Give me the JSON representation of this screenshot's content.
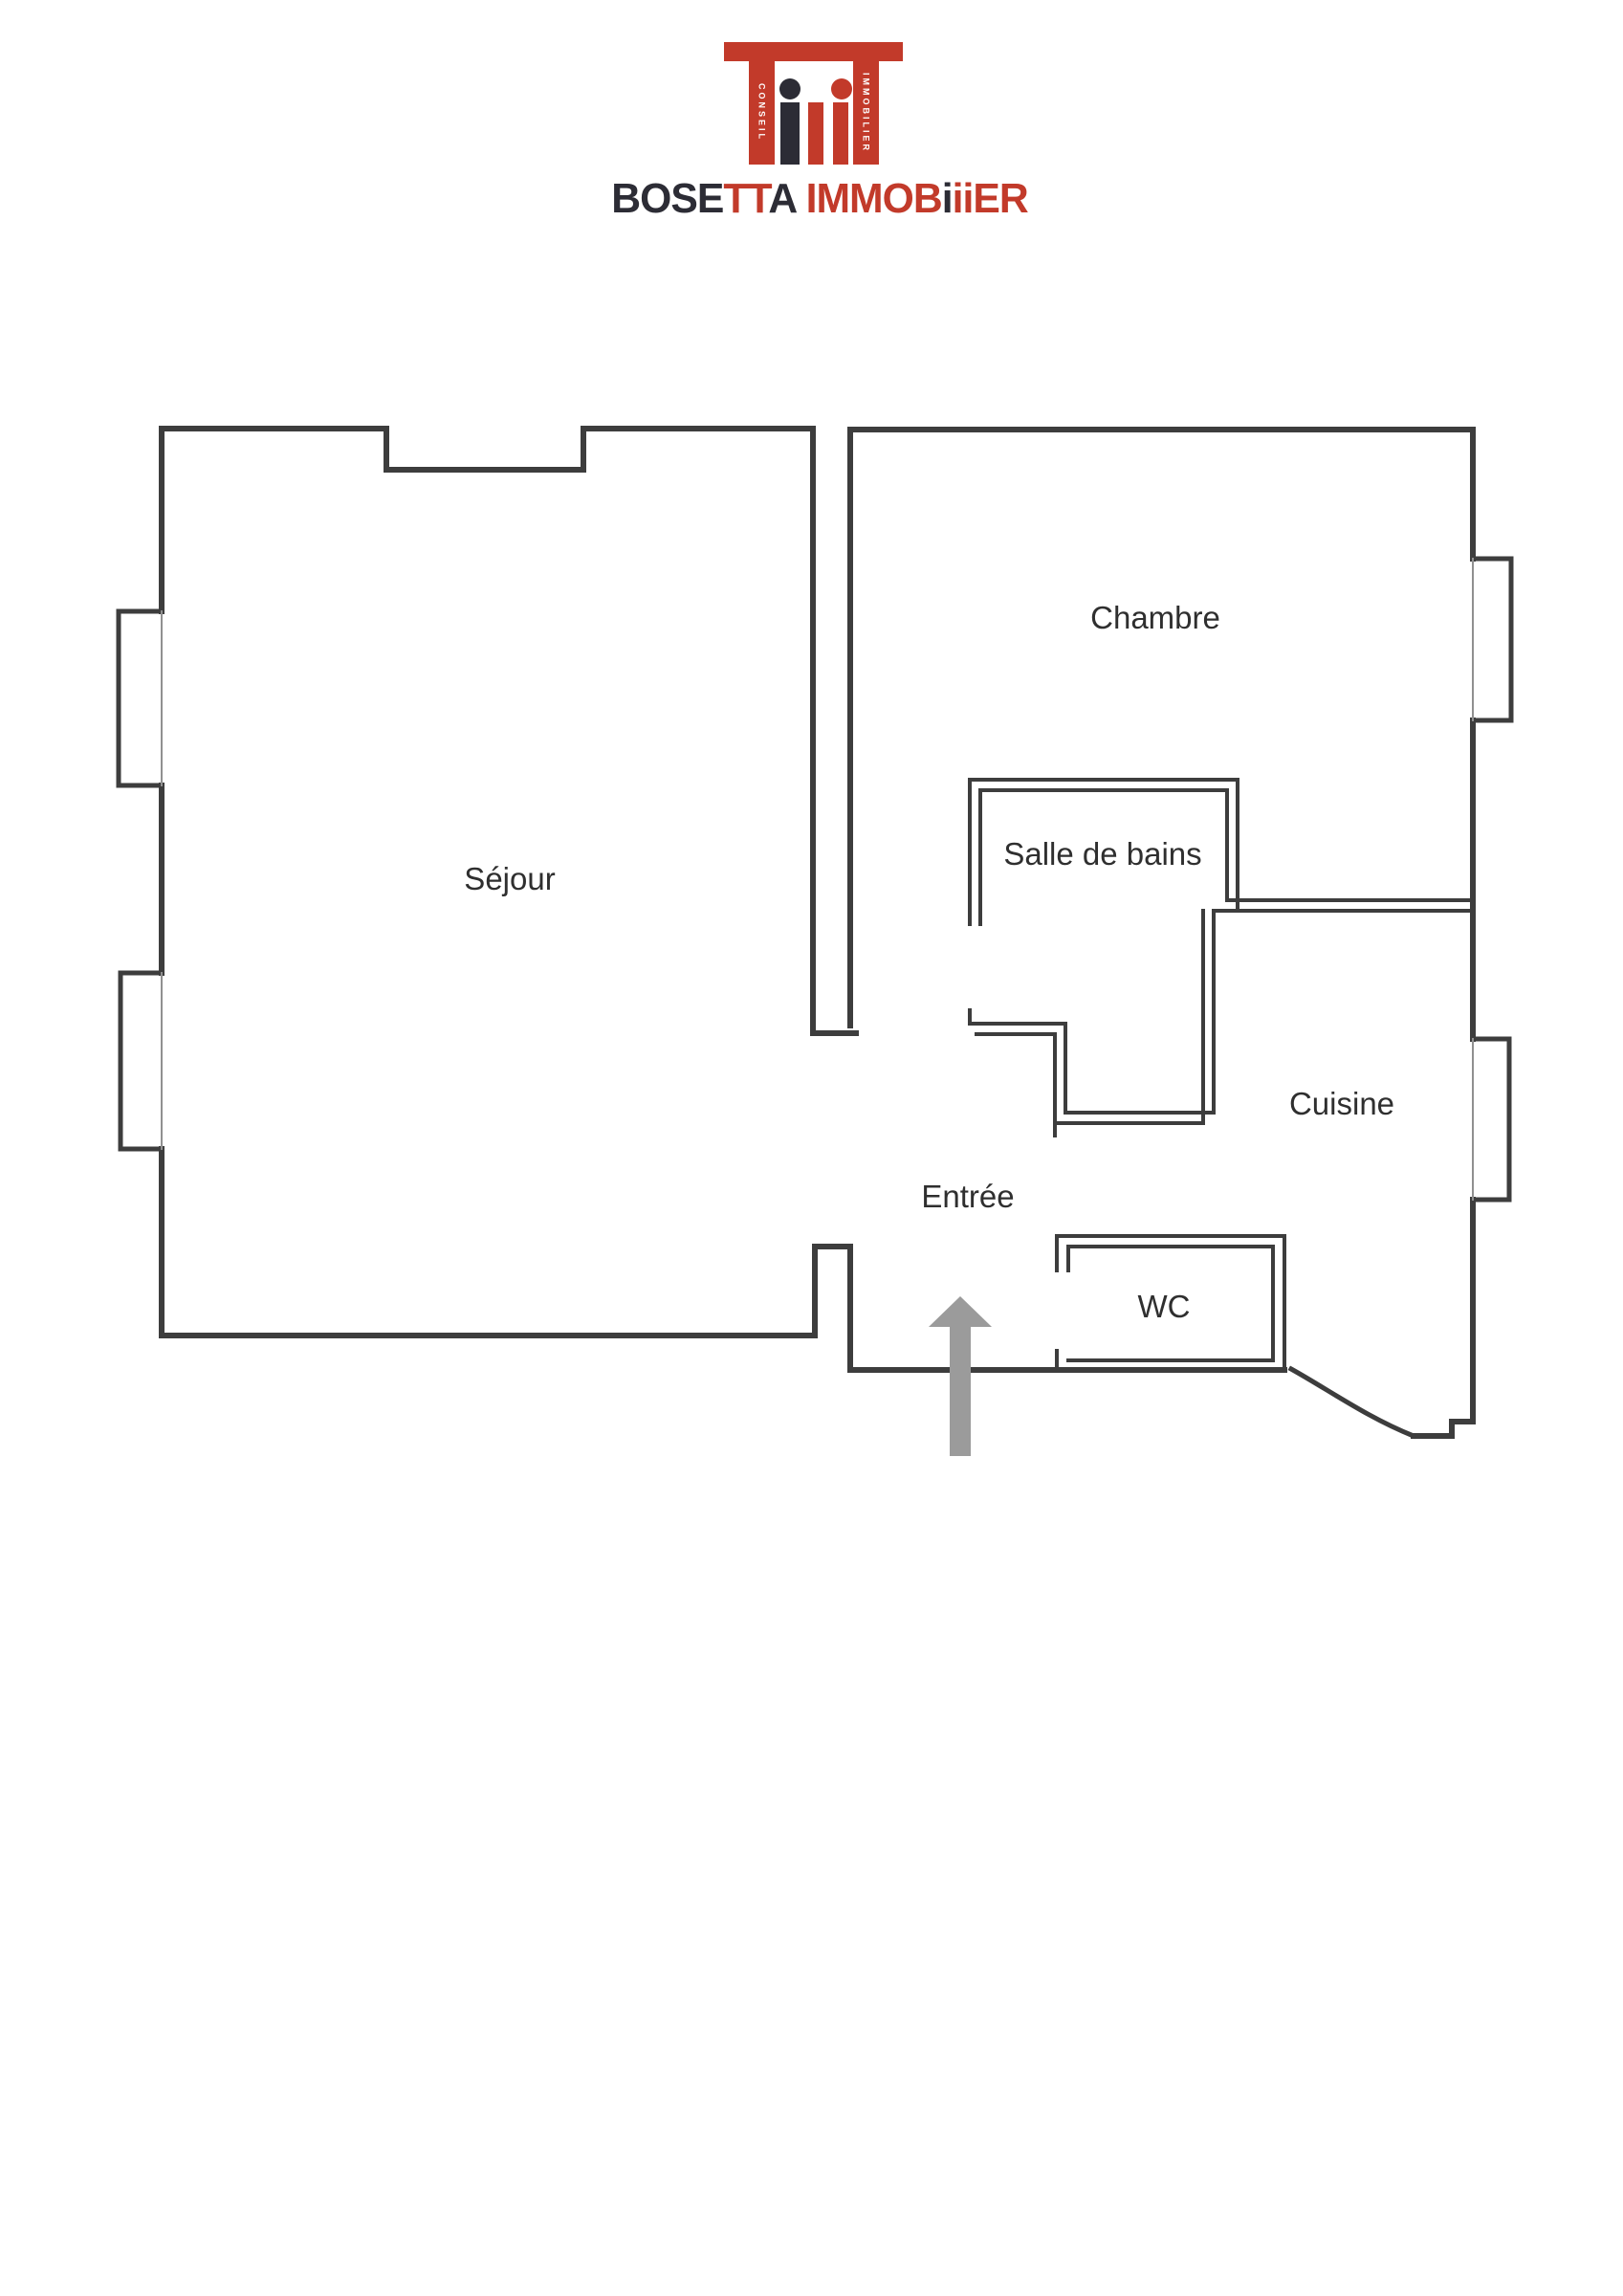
{
  "brand": {
    "wordmark": {
      "p1": "BOSE",
      "p2": "TT",
      "p3": "A",
      "sep": " ",
      "p4": "IMMOB",
      "p5": "i",
      "p6": "ii",
      "p7": "ER"
    },
    "vertical_left": "CONSEIL",
    "vertical_right": "IMMOBILIER"
  },
  "colors": {
    "brand_red": "#c23a2a",
    "brand_dark": "#2c2c35",
    "wall": "#3d3d3d",
    "window_line": "#909090",
    "arrow": "#9b9b9b",
    "label_text": "#2f2f2f",
    "background": "#ffffff"
  },
  "floor_plan": {
    "rooms": [
      {
        "id": "sejour",
        "label": "Séjour"
      },
      {
        "id": "chambre",
        "label": "Chambre"
      },
      {
        "id": "salle-de-bains",
        "label": "Salle de bains"
      },
      {
        "id": "cuisine",
        "label": "Cuisine"
      },
      {
        "id": "entree",
        "label": "Entrée"
      },
      {
        "id": "wc",
        "label": "WC"
      }
    ],
    "entrance_arrow": {
      "direction": "up"
    }
  }
}
